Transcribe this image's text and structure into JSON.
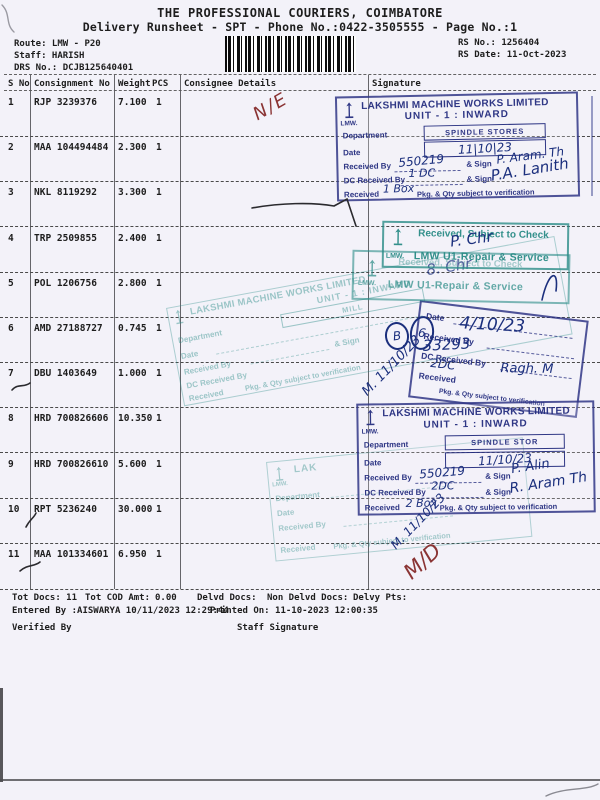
{
  "header": {
    "company": "THE PROFESSIONAL COURIERS, COIMBATORE",
    "subtitle": "Delivery Runsheet - SPT - Phone No.:0422-3505555 - Page No.:1",
    "route": "Route: LMW - P20",
    "staff": "Staff: HARISH",
    "drs_no": "DRS No.: DCJB125640401",
    "rs_no": "RS No.: 1256404",
    "rs_date": "RS Date: 11-Oct-2023"
  },
  "table": {
    "headers": {
      "sno": "S No",
      "consignment": "Consignment No",
      "weight": "Weight",
      "pcs": "PCS",
      "consignee": "Consignee Details",
      "signature": "Signature"
    },
    "rows": [
      {
        "n": "1",
        "c": "RJP 3239376",
        "w": "7.100",
        "p": "1"
      },
      {
        "n": "2",
        "c": "MAA 104494484",
        "w": "2.300",
        "p": "1"
      },
      {
        "n": "3",
        "c": "NKL 8119292",
        "w": "3.300",
        "p": "1"
      },
      {
        "n": "4",
        "c": "TRP 2509855",
        "w": "2.400",
        "p": "1"
      },
      {
        "n": "5",
        "c": "POL 1206756",
        "w": "2.800",
        "p": "1"
      },
      {
        "n": "6",
        "c": "AMD 27188727",
        "w": "0.745",
        "p": "1"
      },
      {
        "n": "7",
        "c": "DBU 1403649",
        "w": "1.000",
        "p": "1"
      },
      {
        "n": "8",
        "c": "HRD 700826606",
        "w": "10.350",
        "p": "1"
      },
      {
        "n": "9",
        "c": "HRD 700826610",
        "w": "5.600",
        "p": "1"
      },
      {
        "n": "10",
        "c": "RPT 5236240",
        "w": "30.000",
        "p": "1"
      },
      {
        "n": "11",
        "c": "MAA 101334601",
        "w": "6.950",
        "p": "1"
      }
    ]
  },
  "footer": {
    "tot_docs": "Tot Docs: 11",
    "tot_cod_label": "Tot COD Amt:",
    "tot_cod_value": "0.00",
    "delvd": "Delvd Docs:",
    "non_delvd": "Non Delvd Docs:",
    "delvy_pts": "Delvy Pts:",
    "entered_by": "Entered By :AISWARYA 10/11/2023 12:29:44",
    "printed_on": "Printed On: 11-10-2023 12:00:35",
    "verified_by": "Verified By",
    "staff_signature": "Staff Signature"
  },
  "stamps": {
    "company": "LAKSHMI MACHINE WORKS LIMITED",
    "unit": "UNIT - 1 : INWARD",
    "lmw": "LMW.",
    "labels": {
      "department": "Department",
      "date": "Date",
      "received_by": "Received By",
      "sign": "& Sign",
      "dc_received_by": "DC Received By",
      "received": "Received",
      "note": "Pkg. & Qty subject to verification"
    },
    "inward_top": {
      "department_value": "SPINDLE STORES",
      "date_value": "11|10|23",
      "received_by_value": "550219",
      "sign_value": "P. Aram. Th",
      "dc_value": "1 DC",
      "dc_sign_value": "P.A. Lanith",
      "received_value": "1 Box"
    },
    "check": {
      "line1": "Received, Subject to Check",
      "line2": "LMW U1-Repair & Service",
      "sig": "P. Chr"
    },
    "check2_sig": "8. Chr",
    "inward_mill": {
      "department_value": "MILL",
      "hw_note": "M. 11/10/23"
    },
    "inward_right": {
      "date_value": "4/10/23",
      "number": "33293",
      "dc_value": "2DC",
      "sign_value": "Ragh. M",
      "circle1": "B",
      "circle2": "6"
    },
    "inward_bottom": {
      "department_value": "SPINDLE STOR",
      "date_value": "11/10/23",
      "received_by_value": "550219",
      "sign_value": "P. Alin",
      "dc_value": "2DC",
      "dc_sign_value": "R. Aram Th",
      "received_value": "2 Box",
      "hw_note": "M. 11/10/23"
    },
    "faint_fragment": "LAK"
  },
  "annotations": {
    "ne_mark": "N/E",
    "md_mark": "M/D"
  },
  "colors": {
    "stamp_navy": "#293082",
    "stamp_teal": "#2a8c87",
    "ink_blue": "#1b2f7d",
    "ink_red": "#8a3434",
    "paper": "#f3f2f9"
  }
}
